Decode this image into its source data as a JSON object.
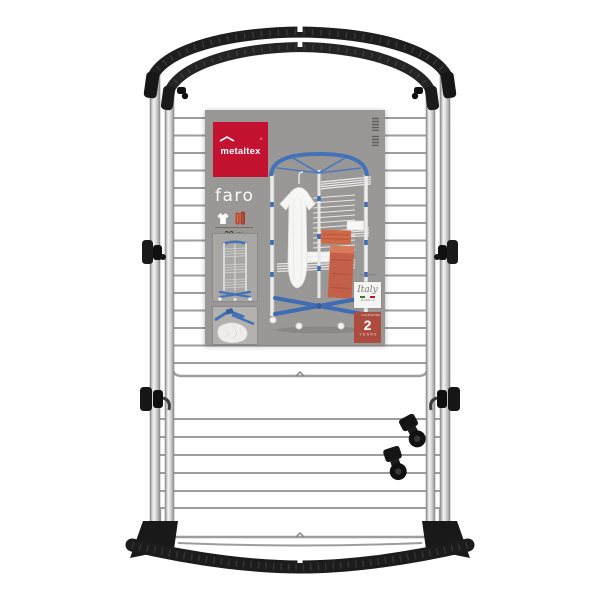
{
  "photo": {
    "subject": "tower clothes drying rack product photo"
  },
  "label": {
    "brand": "metaltex",
    "brand_mark": "®",
    "product_name": "faro",
    "capacity": "28 m",
    "icons": [
      "shirt-icon",
      "towels-icon"
    ],
    "badges": {
      "quality_note": "quality warranty",
      "made_in": {
        "script": "Italy",
        "caption": "MADE IN"
      },
      "guarantee": {
        "top": "GUARANTEE",
        "value": "2",
        "bottom": "YEARS"
      }
    }
  },
  "colors": {
    "brand_red": "#c41330",
    "badge_red": "#ab4c3f",
    "label_grey": "#9a9896",
    "frame_blue": "#4472b8",
    "towel_orange": "#cf6a49",
    "frame_black": "#1d1d1d",
    "chrome_grey": "#bdbdbd"
  }
}
